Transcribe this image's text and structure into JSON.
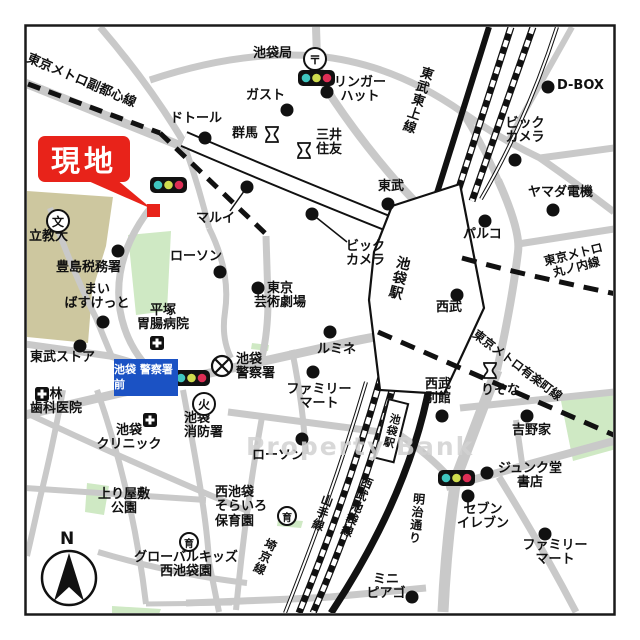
{
  "marker": {
    "label": "現地"
  },
  "watermark": "Property Bank",
  "compass": {
    "label": "N"
  },
  "bus_stop_sign": {
    "text": "池袋\n警察署前"
  },
  "stations": [
    {
      "id": "ikebukuro-main",
      "label": "池袋駅"
    },
    {
      "id": "ikebukuro-seibu",
      "label": "池袋駅"
    }
  ],
  "railways": [
    {
      "id": "fukutoshin",
      "label": "東京メトロ副都心線"
    },
    {
      "id": "tobu-tojo",
      "label": "東武東上線"
    },
    {
      "id": "marunouchi",
      "label": "東京メトロ\n丸ノ内線"
    },
    {
      "id": "yurakucho",
      "label": "東京メトロ有楽町線"
    },
    {
      "id": "yamanote",
      "label": "山手線"
    },
    {
      "id": "saikyo",
      "label": "埼京線"
    },
    {
      "id": "seibu-ikebukuro",
      "label": "西武池袋線"
    }
  ],
  "roads": [
    {
      "id": "meiji-dori",
      "label": "明治通り"
    }
  ],
  "icons": {
    "post_office": "〒",
    "school": "文",
    "fire": "火",
    "nursery": "育"
  },
  "colors": {
    "road_gray": "#c9c9c9",
    "park_green": "#cfe9c4",
    "campus_khaki": "#cdc79f",
    "marker_red": "#e8231a",
    "sign_blue": "#1b52c4",
    "signal_teal": "#3fc6c0",
    "signal_yellow": "#cfdc4e",
    "signal_red": "#dd2e55"
  },
  "places": [
    {
      "name": "池袋局",
      "icon": "post-office"
    },
    {
      "name": "ガスト"
    },
    {
      "name": "リンガー\nハット"
    },
    {
      "name": "ドトール"
    },
    {
      "name": "群馬",
      "icon": "bank"
    },
    {
      "name": "三井\n住友",
      "icon": "bank"
    },
    {
      "name": "D-BOX"
    },
    {
      "name": "ビック\nカメラ"
    },
    {
      "name": "ヤマダ電機"
    },
    {
      "name": "パルコ"
    },
    {
      "name": "東武"
    },
    {
      "name": "西武"
    },
    {
      "name": "マルイ"
    },
    {
      "name": "ローソン"
    },
    {
      "name": "豊島税務署"
    },
    {
      "name": "まい\nばすけっと"
    },
    {
      "name": "平塚\n胃腸病院",
      "icon": "hospital"
    },
    {
      "name": "東武ストア"
    },
    {
      "name": "立教大",
      "icon": "school"
    },
    {
      "name": "林\n歯科医院",
      "icon": "hospital"
    },
    {
      "name": "池袋\nクリニック",
      "icon": "hospital"
    },
    {
      "name": "池袋\n消防署",
      "icon": "fire"
    },
    {
      "name": "池袋\n警察署",
      "icon": "police"
    },
    {
      "name": "東京\n芸術劇場"
    },
    {
      "name": "ビック\nカメラ"
    },
    {
      "name": "ルミネ"
    },
    {
      "name": "ファミリー\nマート"
    },
    {
      "name": "ローソン"
    },
    {
      "name": "西池袋\nそらいろ\n保育園",
      "icon": "nursery"
    },
    {
      "name": "上り屋敷\n公園"
    },
    {
      "name": "グローバルキッズ\n西池袋園",
      "icon": "nursery"
    },
    {
      "name": "西武\n別館"
    },
    {
      "name": "りそな",
      "icon": "bank"
    },
    {
      "name": "吉野家"
    },
    {
      "name": "ジュンク堂\n書店"
    },
    {
      "name": "セブン\nイレブン"
    },
    {
      "name": "ファミリー\nマート"
    },
    {
      "name": "ミニ\nピアゴ"
    }
  ]
}
